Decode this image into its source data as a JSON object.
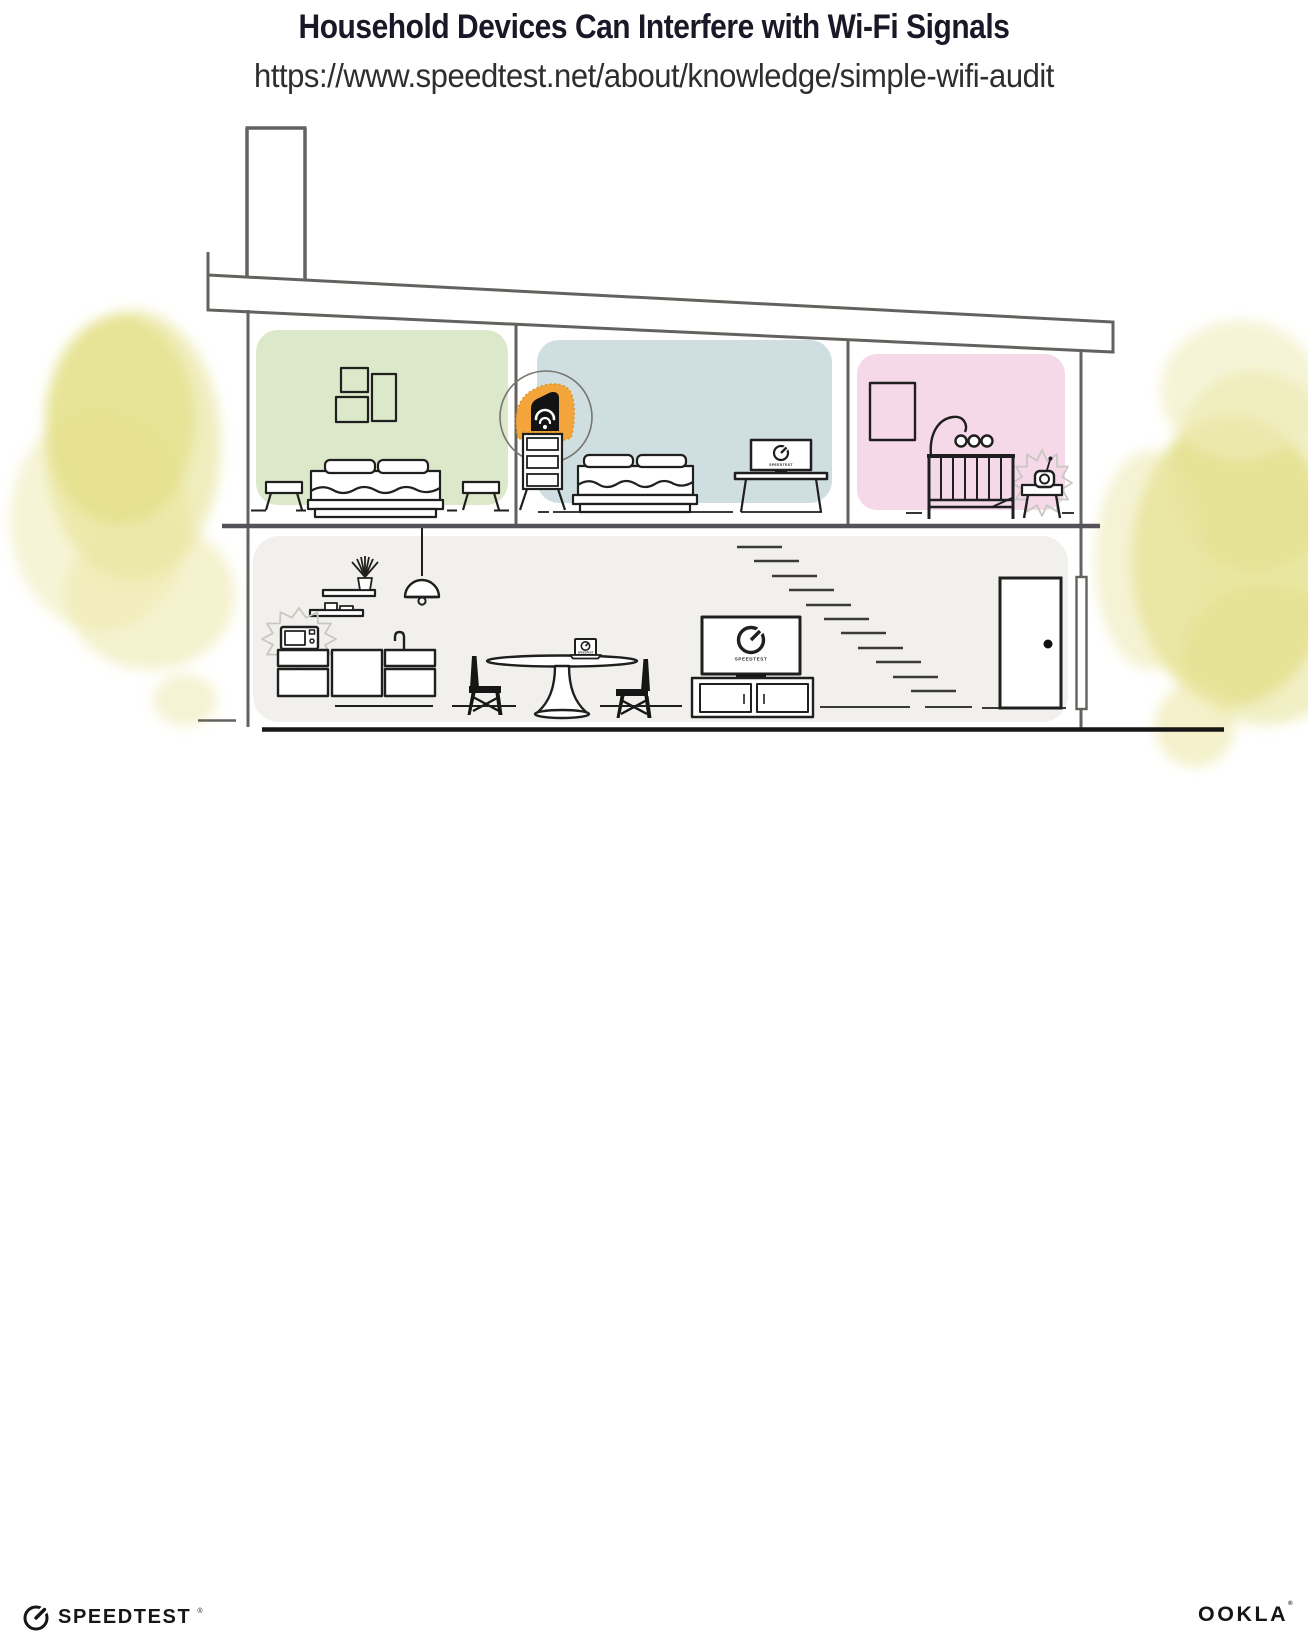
{
  "header": {
    "title": "Household Devices Can Interfere with Wi-Fi Signals",
    "url": "https://www.speedtest.net/about/knowledge/simple-wifi-audit"
  },
  "branding": {
    "speedtest_wordmark": "SPEEDTEST",
    "speedtest_reg_mark": "®",
    "ookla_wordmark": "OOKLA",
    "ookla_reg_mark": "®"
  },
  "illustration": {
    "tv_screen_label": "SPEEDTEST",
    "desk_monitor_label": "SPEEDTEST",
    "laptop_screen_label": "SPEEDTEST",
    "colors": {
      "room_green": "#dce8ca",
      "room_blue": "#cfdfe1",
      "room_pink": "#f5d9e8",
      "lower_floor": "#f1f0ed",
      "router_highlight": "#f3a53b",
      "foliage": "#e4e089",
      "foliage_light": "#ece8a8",
      "foliage_pale": "#f0edbc",
      "structure_line": "#64625e",
      "ink": "#1f1f1f",
      "interference": "#c8c8c1"
    }
  }
}
